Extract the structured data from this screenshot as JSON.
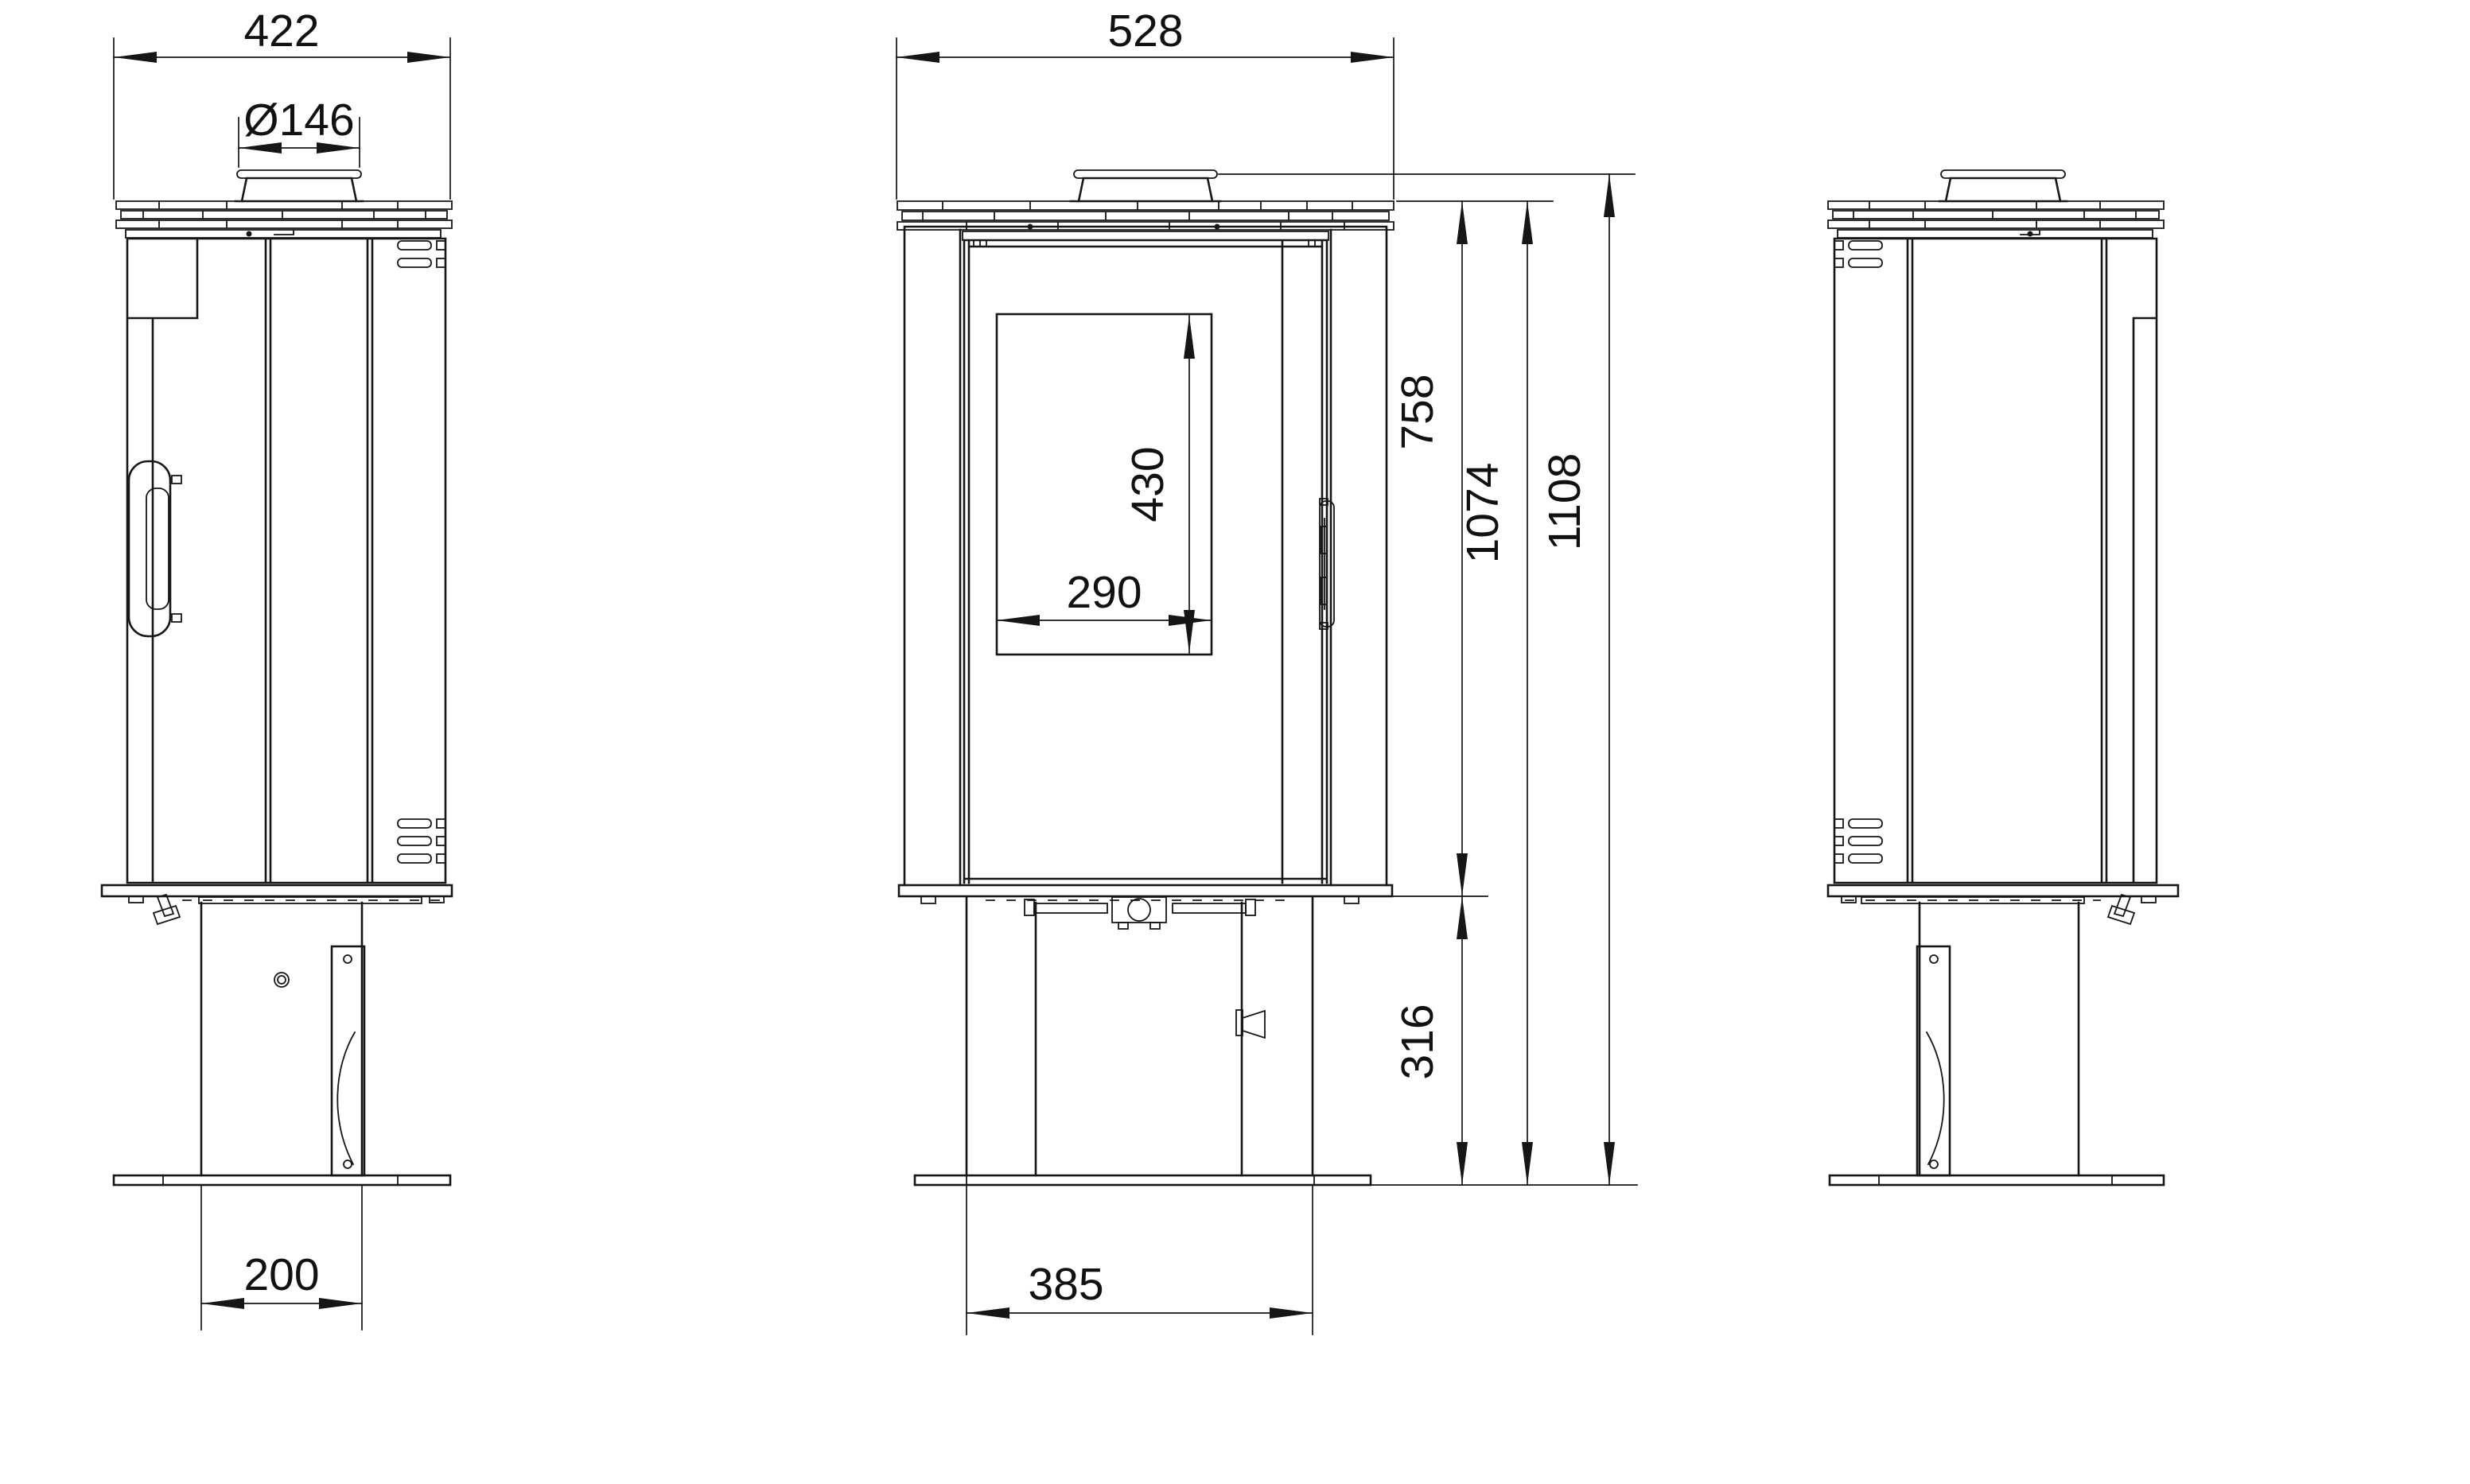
{
  "style": {
    "background": "#ffffff",
    "line_color": "#161616",
    "text_color": "#111111"
  },
  "dims": {
    "depth": "422",
    "flue_diameter": "Ø146",
    "pedestal_depth": "200",
    "width": "528",
    "glass_height": "430",
    "glass_width": "290",
    "pedestal_width": "385",
    "body_span": "758",
    "floor_to_body_top": "1074",
    "overall_height": "1108",
    "floor_to_body": "316"
  }
}
